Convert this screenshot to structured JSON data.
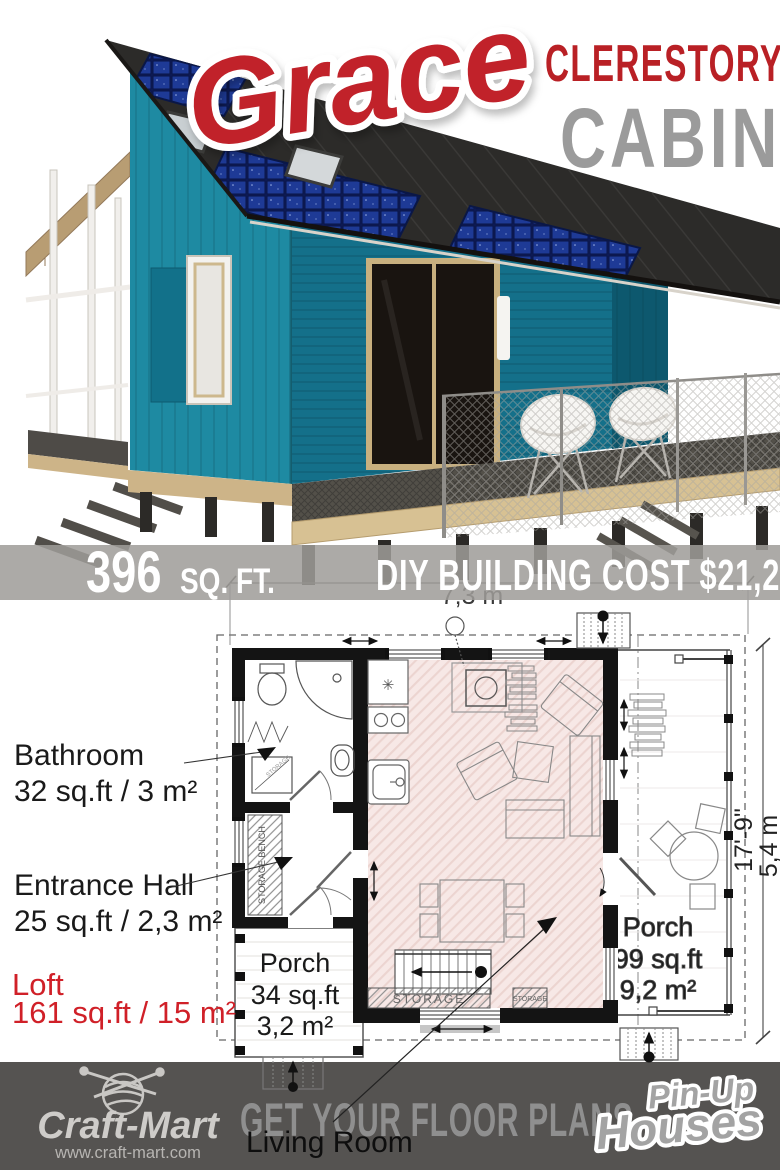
{
  "hero": {
    "script_title": "Grace",
    "title_top": "CLERESTORY",
    "title_bottom": "CABIN"
  },
  "banner": {
    "area_number": "396",
    "area_unit": "SQ. FT.",
    "cost": "DIY BUILDING COST $21,200"
  },
  "plan": {
    "dim_width": "7,3 m",
    "dim_height_ft": "17'-9\"",
    "dim_height_m": "5,4 m",
    "bathroom_name": "Bathroom",
    "bathroom_size": "32 sq.ft / 3 m²",
    "hall_name": "Entrance Hall",
    "hall_size": "25 sq.ft / 2,3 m²",
    "loft_name": "Loft",
    "loft_size": "161 sq.ft / 15 m²",
    "porch_small_name": "Porch",
    "porch_small_size_ft": "34 sq.ft",
    "porch_small_size_m": "3,2 m²",
    "porch_large_name": "Porch",
    "porch_large_size_ft": "99 sq.ft",
    "porch_large_size_m": "9,2 m²",
    "living_room": "Living Room",
    "storage": "STORAGE",
    "storage_small": "STORAGE",
    "storage_bench": "STORAGE BENCH",
    "cabinet_label": "STORAGE"
  },
  "footer": {
    "brand": "Craft-Mart",
    "brand_url": "www.craft-mart.com",
    "cta": "GET YOUR FLOOR PLANS",
    "partner_line1": "Pin-Up",
    "partner_line2": "Houses"
  },
  "colors": {
    "script_red": "#c1212b",
    "title_red": "#b92025",
    "title_gray": "#9b9b9b",
    "banner_bg": "#9e9c98",
    "footer_bg": "#555351",
    "loft_red": "#d02028",
    "plan_floor_pink": "#f7e8e6",
    "cabin_teal_front": "#1e8aa2",
    "cabin_teal_side": "#14708a",
    "roof_dark": "#2c2b29",
    "solar_blue": "#1e3a96",
    "deck_wood": "#d7c193"
  }
}
